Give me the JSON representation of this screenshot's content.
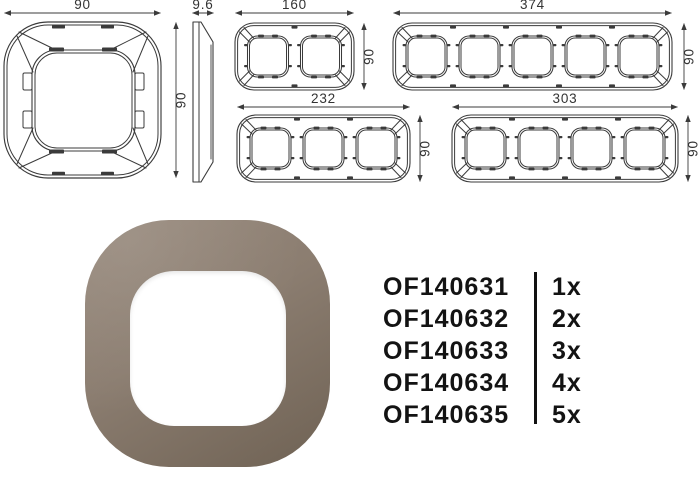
{
  "document": {
    "type": "product-dimension-sheet"
  },
  "colors": {
    "line": "#3b3b3b",
    "dim_text": "#333333",
    "product_light": "#97897c",
    "product_mid": "#8b7d70",
    "product_dark": "#6f6254",
    "text": "#131313"
  },
  "dimensions": {
    "front_1g": {
      "width": "90",
      "height": "90",
      "gangs": 1
    },
    "side": {
      "depth": "9.6"
    },
    "front_2g": {
      "width": "160",
      "height": "90",
      "gangs": 2
    },
    "front_5g": {
      "width": "374",
      "height": "90",
      "gangs": 5
    },
    "front_3g": {
      "width": "232",
      "height": "90",
      "gangs": 3
    },
    "front_4g": {
      "width": "303",
      "height": "90",
      "gangs": 4
    }
  },
  "parts": [
    {
      "ref": "OF140631",
      "qty": "1x"
    },
    {
      "ref": "OF140632",
      "qty": "2x"
    },
    {
      "ref": "OF140633",
      "qty": "3x"
    },
    {
      "ref": "OF140634",
      "qty": "4x"
    },
    {
      "ref": "OF140635",
      "qty": "5x"
    }
  ]
}
